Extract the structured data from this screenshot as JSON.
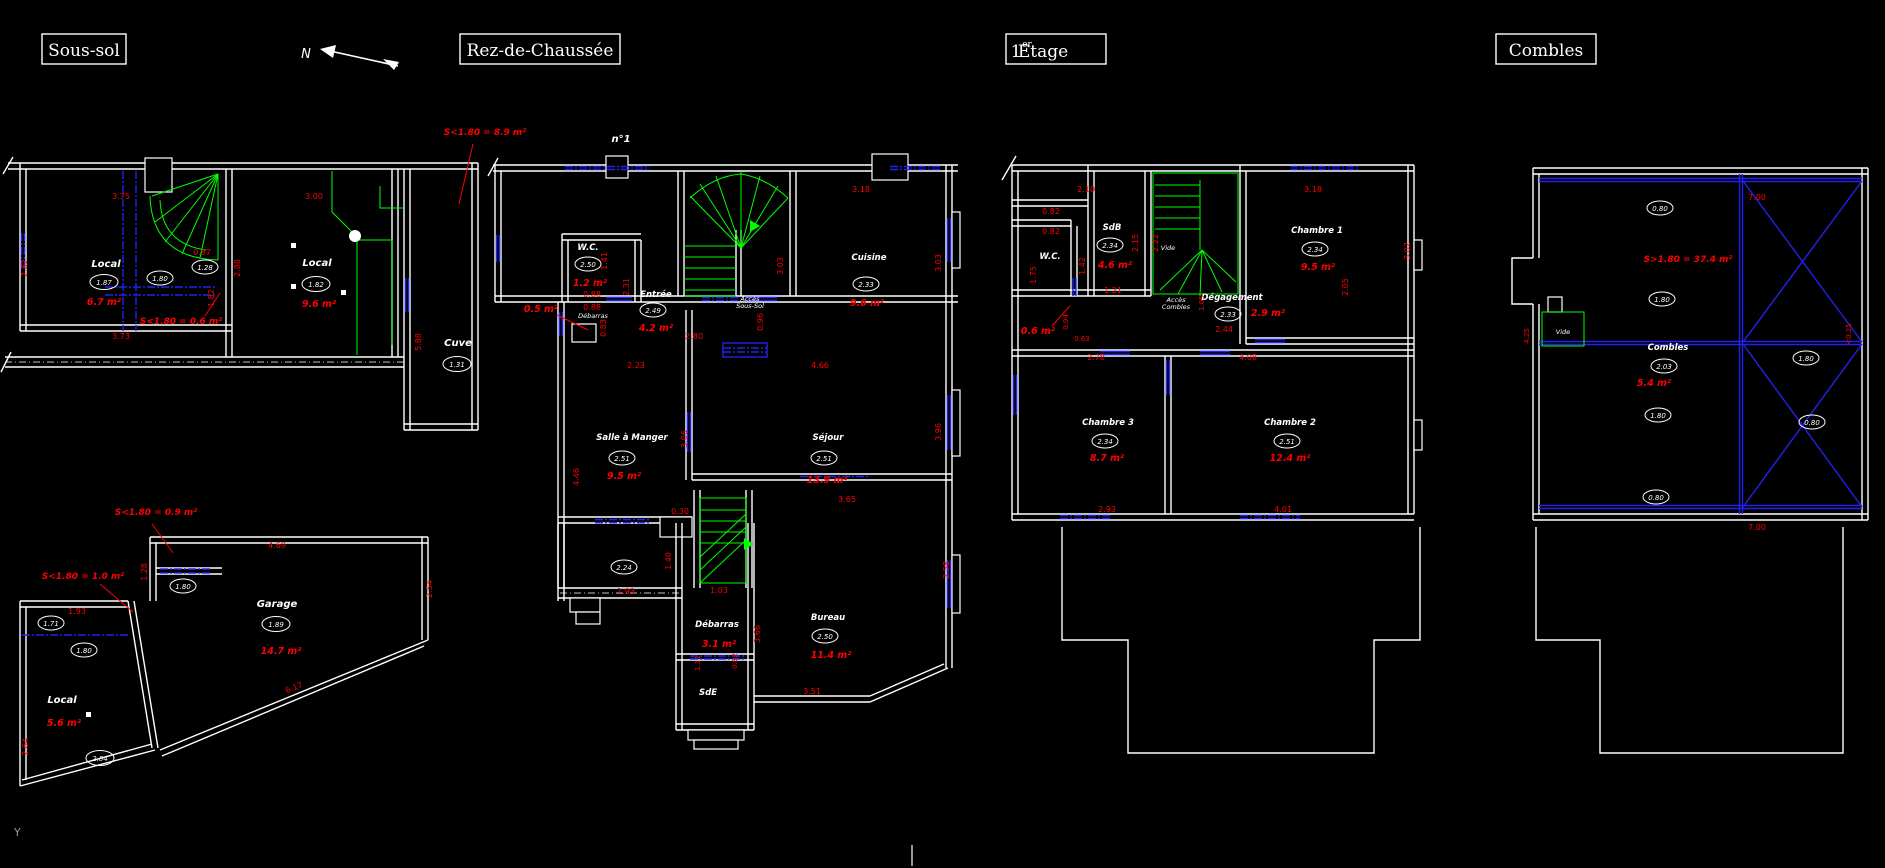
{
  "app": {
    "north_label": "N",
    "origin_label": "Y",
    "colors": {
      "background": "#000000",
      "walls": "#ffffff",
      "dimensions": "#ff0000",
      "stairs": "#00ff00",
      "openings": "#2222ee"
    }
  },
  "soussol": {
    "title": "Sous-sol",
    "rooms": [
      {
        "name": "Local",
        "level": "1.87",
        "area": "6.7 m²"
      },
      {
        "name": "Local",
        "level": "1.82",
        "area": "9.6 m²"
      },
      {
        "name": "Cuve",
        "level": "1.31"
      },
      {
        "name": "Garage",
        "level": "1.89",
        "area": "14.7 m²"
      },
      {
        "name": "Local",
        "level": "2.04",
        "area": "5.6 m²"
      }
    ],
    "door_levels": [
      "1.80",
      "1.28",
      "1.80",
      "1.71",
      "1.80"
    ],
    "low_notes": [
      "S<1.80 = 8.9 m²",
      "S<1.80 = 0.6 m²",
      "S<1.80 = 0.9 m²",
      "S<1.80 = 1.0 m²"
    ],
    "dims": [
      "3.75",
      "2.82",
      "0.87",
      "1.82",
      "3.73",
      "3.00",
      "2.88",
      "5.88",
      "4.69",
      "1.28",
      "1.93",
      "2.54",
      "6.17",
      "2.64"
    ]
  },
  "rdc": {
    "title": "Rez-de-Chaussée",
    "house_number": "n°1",
    "rooms": [
      {
        "name": "W.C.",
        "level": "2.50",
        "area": "1.2 m²"
      },
      {
        "name": "Entrée",
        "level": "2.49",
        "area": "4.2 m²"
      },
      {
        "name": "Cuisine",
        "level": "2.33",
        "area": "9.6 m²"
      },
      {
        "name": "Salle à Manger",
        "level": "2.51",
        "area": "9.5 m²"
      },
      {
        "name": "Séjour",
        "level": "2.51",
        "area": "13.9 m²"
      },
      {
        "name": "Débarras",
        "area": "3.1 m²"
      },
      {
        "name": "SdE"
      },
      {
        "name": "Bureau",
        "level": "2.50",
        "area": "11.4 m²"
      },
      {
        "name": "Débarras",
        "area": "0.5 m²"
      }
    ],
    "extra_levels": [
      "2.24"
    ],
    "stair_note": [
      "Accès",
      "Sous-Sol"
    ],
    "dims": [
      "0.88",
      "1.41",
      "2.31",
      "0.88",
      "0.83",
      "2.80",
      "0.96",
      "3.03",
      "3.18",
      "3.03",
      "2.23",
      "4.46",
      "3.06",
      "4.66",
      "3.96",
      "0.30",
      "1.40",
      "1.93",
      "1.03",
      "3.66",
      "1.11",
      "0.82",
      "3.65",
      "2.58",
      "3.51"
    ]
  },
  "etage1": {
    "title_num": "1",
    "title_sup": "er",
    "title_word": "Etage",
    "rooms": [
      {
        "name": "W.C."
      },
      {
        "name": "SdB",
        "level": "2.34",
        "area": "4.6 m²"
      },
      {
        "name": "Dégagement",
        "level": "2.33",
        "area": "2.9 m²"
      },
      {
        "name": "Chambre 1",
        "level": "2.34",
        "area": "9.5 m²"
      },
      {
        "name": "Chambre 3",
        "level": "2.34",
        "area": "8.7 m²"
      },
      {
        "name": "Chambre 2",
        "level": "2.51",
        "area": "12.4 m²"
      }
    ],
    "void_label": "Vide",
    "low_note": "0.6 m²",
    "stair_note": [
      "Accès",
      "Combles"
    ],
    "dims": [
      "2.10",
      "0.82",
      "0.82",
      "1.75",
      "1.42",
      "2.15",
      "2.22",
      "1.21",
      "0.94",
      "0.63",
      "1.05",
      "2.44",
      "3.18",
      "3.02",
      "2.05",
      "2.78",
      "4.08",
      "2.93",
      "4.01"
    ]
  },
  "combles": {
    "title": "Combles",
    "room": {
      "name": "Combles",
      "level": "2.03",
      "area": "5.4 m²"
    },
    "void_label": "Vide",
    "surface_note": "S>1.80 = 37.4 m²",
    "height_levels": [
      "0.80",
      "1.80",
      "1.80",
      "0.80",
      "1.80",
      "0.80"
    ],
    "dims": [
      "7.00",
      "7.00",
      "4.25",
      "<0.25"
    ]
  }
}
